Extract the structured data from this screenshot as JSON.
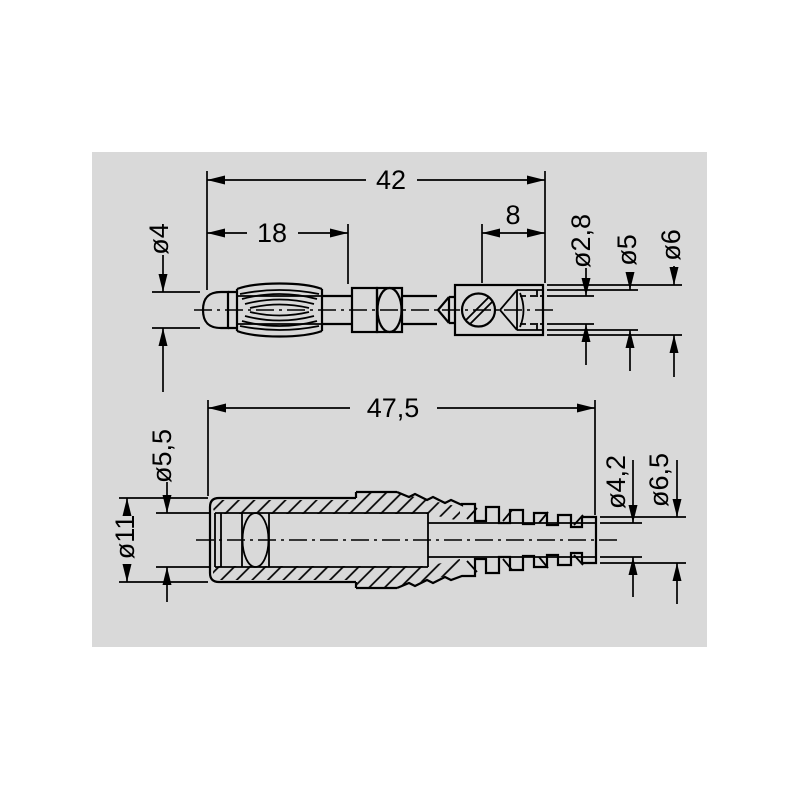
{
  "page": {
    "background": "#ffffff",
    "panel_background": "#d9d9d9",
    "line_color": "#000000"
  },
  "drawing": {
    "title": "Connector dimensional drawing",
    "views": [
      {
        "id": "plug",
        "name": "Banana plug side view",
        "dims": {
          "overall_length": "42",
          "insertion_length": "18",
          "rear_body_length": "8",
          "pin_diameter": "ø4",
          "bore_diameter": "ø2,8",
          "sleeve_diameter": "ø5",
          "body_diameter": "ø6"
        }
      },
      {
        "id": "socket",
        "name": "Socket with strain relief boot side view",
        "dims": {
          "overall_length": "47,5",
          "bore_diameter": "ø5,5",
          "body_diameter": "ø11",
          "cable_hole_diameter": "ø4,2",
          "boot_end_diameter": "ø6,5"
        }
      }
    ]
  }
}
